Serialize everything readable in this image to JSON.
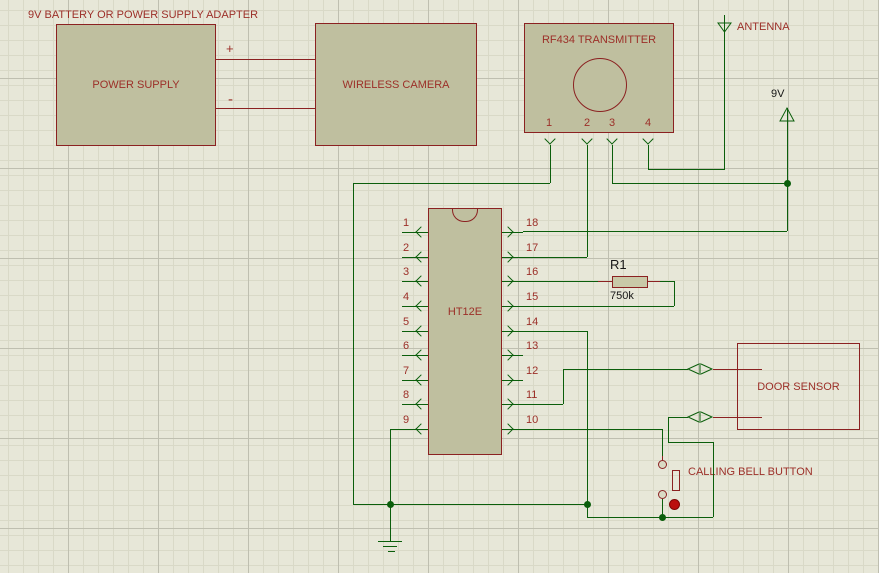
{
  "title": "9V BATTERY OR POWER SUPPLY ADAPTER",
  "power_supply": {
    "label": "POWER SUPPLY",
    "plus": "+",
    "minus": "-"
  },
  "wireless_camera": {
    "label": "WIRELESS CAMERA"
  },
  "rf_transmitter": {
    "label": "RF434 TRANSMITTER",
    "pins": [
      "1",
      "2",
      "3",
      "4"
    ]
  },
  "antenna": {
    "label": "ANTENNA"
  },
  "power_terminal": {
    "label": "9V"
  },
  "ic": {
    "name": "HT12E",
    "left_pins": [
      "1",
      "2",
      "3",
      "4",
      "5",
      "6",
      "7",
      "8",
      "9"
    ],
    "right_pins": [
      "18",
      "17",
      "16",
      "15",
      "14",
      "13",
      "12",
      "11",
      "10"
    ]
  },
  "resistor": {
    "ref": "R1",
    "value": "750k"
  },
  "door_sensor": {
    "label": "DOOR SENSOR"
  },
  "calling_bell": {
    "label": "CALLING BELL BUTTON"
  },
  "colors": {
    "wire_green": "#0b5e0b",
    "component_red": "#8b2121",
    "component_fill": "#bfbf9f",
    "label_red": "#9c2f28",
    "background": "#e7e7d8",
    "button_dot": "#bb0e0e"
  }
}
